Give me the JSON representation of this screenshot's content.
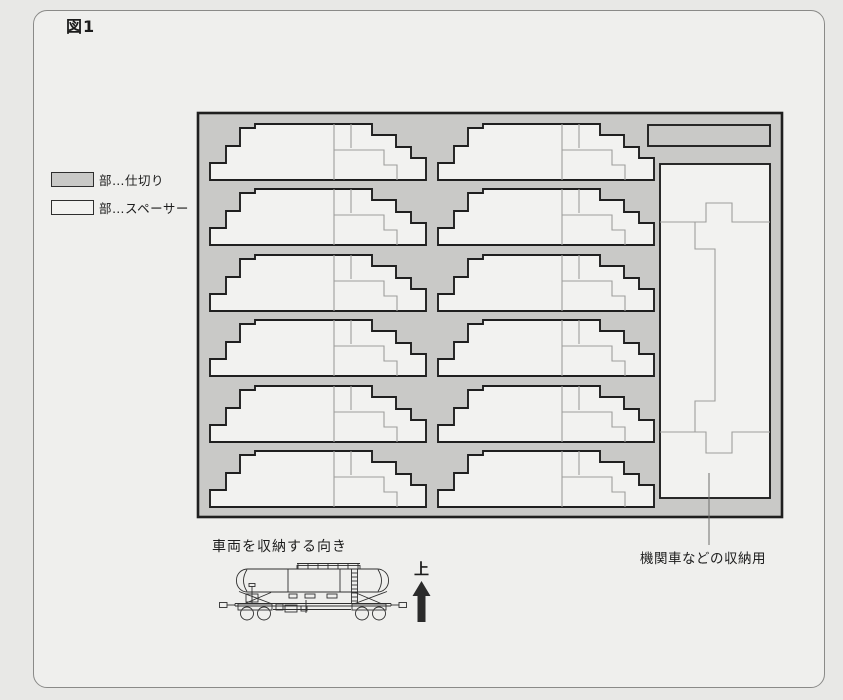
{
  "figure": {
    "label": "図1"
  },
  "legend": {
    "items": [
      {
        "type": "partition",
        "label": "部…仕切り"
      },
      {
        "type": "spacer",
        "label": "部…スペーサー"
      }
    ]
  },
  "labels": {
    "storage_direction": "車両を収納する向き",
    "up": "上",
    "locomotive_storage": "機関車などの収納用"
  },
  "colors": {
    "page_bg": "#e8e8e6",
    "panel_bg": "#efefed",
    "panel_border": "#8a8a88",
    "tray_fill": "#c9c9c7",
    "outline": "#1f1f1f",
    "spacer_fill": "#f2f2f0",
    "inner_line": "#9e9e9c",
    "text": "#1c1c1c",
    "arrow": "#2b2b2b"
  },
  "diagram": {
    "tray": {
      "x": 198,
      "y": 113,
      "w": 584,
      "h": 404
    },
    "grid": {
      "cols_x": [
        210,
        438
      ],
      "rows_y": [
        124,
        189,
        255,
        320,
        386,
        451
      ]
    },
    "spacer_outline": [
      [
        0,
        56
      ],
      [
        0,
        39
      ],
      [
        16,
        39
      ],
      [
        16,
        22
      ],
      [
        30,
        22
      ],
      [
        30,
        4
      ],
      [
        45,
        4
      ],
      [
        45,
        0
      ],
      [
        162,
        0
      ],
      [
        162,
        11
      ],
      [
        186,
        11
      ],
      [
        186,
        23
      ],
      [
        201,
        23
      ],
      [
        201,
        34
      ],
      [
        216,
        34
      ],
      [
        216,
        56
      ]
    ],
    "spacer_inner": [
      [
        [
          124,
          0
        ],
        [
          124,
          56
        ]
      ],
      [
        [
          141,
          0
        ],
        [
          141,
          24
        ]
      ],
      [
        [
          124,
          26
        ],
        [
          174,
          26
        ],
        [
          174,
          41
        ],
        [
          187,
          41
        ],
        [
          187,
          56
        ]
      ]
    ],
    "top_strip": {
      "x": 648,
      "y": 125,
      "w": 122,
      "h": 21
    },
    "loco_bay": {
      "x": 660,
      "y": 164,
      "w": 110,
      "h": 334
    },
    "loco_bay_inner": [
      [
        [
          0,
          58
        ],
        [
          46,
          58
        ],
        [
          46,
          39
        ],
        [
          72,
          39
        ],
        [
          72,
          58
        ],
        [
          110,
          58
        ]
      ],
      [
        [
          35,
          58
        ],
        [
          35,
          85
        ],
        [
          55,
          85
        ],
        [
          55,
          237
        ],
        [
          35,
          237
        ],
        [
          35,
          268
        ]
      ],
      [
        [
          0,
          268
        ],
        [
          46,
          268
        ],
        [
          46,
          289
        ],
        [
          72,
          289
        ],
        [
          72,
          268
        ],
        [
          110,
          268
        ]
      ]
    ],
    "leader": {
      "x": 709,
      "y1": 473,
      "y2": 545
    }
  }
}
